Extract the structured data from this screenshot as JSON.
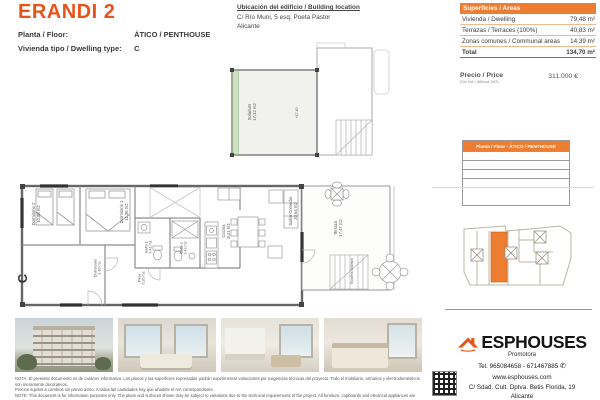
{
  "colors": {
    "accent": "#ED7D31",
    "title_orange": "#E8531B",
    "table_header": "#ED7D31"
  },
  "header": {
    "title": "ERANDI 2",
    "floor_label": "Planta / Floor:",
    "floor_value": "ÁTICO / PENTHOUSE",
    "type_label": "Vivienda tipo / Dwelling type:",
    "type_value": "C"
  },
  "location": {
    "heading": "Ubicación del edificio / Building location",
    "address": "C/ Río Muni, 5 esq. Poeta Pastor",
    "city": "Alicante"
  },
  "areas_table": {
    "header": "Superficies / Areas",
    "rows": [
      {
        "label": "Vivienda / Dwelling",
        "value": "79,48 m²"
      },
      {
        "label": "Terrazas / Terraces (100%)",
        "value": "40,83 m²"
      },
      {
        "label": "Zonas comunes / Communal areas",
        "value": "14,39 m²"
      }
    ],
    "total_label": "Total",
    "total_value": "134,70 m²"
  },
  "price": {
    "label": "Precio / Price",
    "sublabel": "(Sin IVA / Without VAT)",
    "value": "311.000 €"
  },
  "floor_table": {
    "header": "Planta / Floor - ÁTICO / PENTHOUSE"
  },
  "plan": {
    "unit_letter": "C",
    "level_mark": "+17,40",
    "rooms": [
      {
        "name": "Solarium",
        "area": "17,12 m2"
      },
      {
        "name": "Dormitorio 2",
        "area": "10,88 m2"
      },
      {
        "name": "Dormitorio 1",
        "area": "11,36 m2"
      },
      {
        "name": "Distribuidor",
        "area": "1,46 m2"
      },
      {
        "name": "Baño 1",
        "area": "4,41 m2"
      },
      {
        "name": "Baño 2",
        "area": "3,42 m2"
      },
      {
        "name": "Paso",
        "area": "6,26 m2"
      },
      {
        "name": "Cocina",
        "area": "8,41 m2"
      },
      {
        "name": "Salón Comedor",
        "area": "20,64 m2"
      },
      {
        "name": "Terraza",
        "area": "17,47 m2"
      },
      {
        "name": "Escalera Solárium",
        "area": ""
      }
    ]
  },
  "photos": [
    "building-exterior",
    "living-room",
    "kitchen-living-room",
    "bedroom"
  ],
  "footer": {
    "disclaimer_lines": [
      "NOTA: El presente documento es de carácter informativo. Los planos y las superficies expresadas podrán experimentar variaciones por exigencias técnicas del proyecto. Todo el mobiliario, armarios y electrodomésticos son meramente decorativos.",
      "Precios sujetos a cambios sin previo aviso. A todas las cantidades hay que añadirle el IVA correspondiente.",
      "NOTE: This document is for information purposes only. The plans and surfaces shown may be subject to variations due to the technical requirements of the project. All furniture, cupboards and electrical appliances are purely decorative.",
      "Prices subject to change without notice. VAT must be added to all amounts."
    ]
  },
  "brand": {
    "name": "ESPHOUSES",
    "tagline": "Promotora",
    "phone": "Tel. 965084658 - 671467885",
    "website": "www.esphouses.com",
    "address": "C/ Sdad. Cult. Dptva. Betis Florida, 19",
    "city": "Alicante"
  },
  "icons": {
    "whatsapp": "✆"
  }
}
